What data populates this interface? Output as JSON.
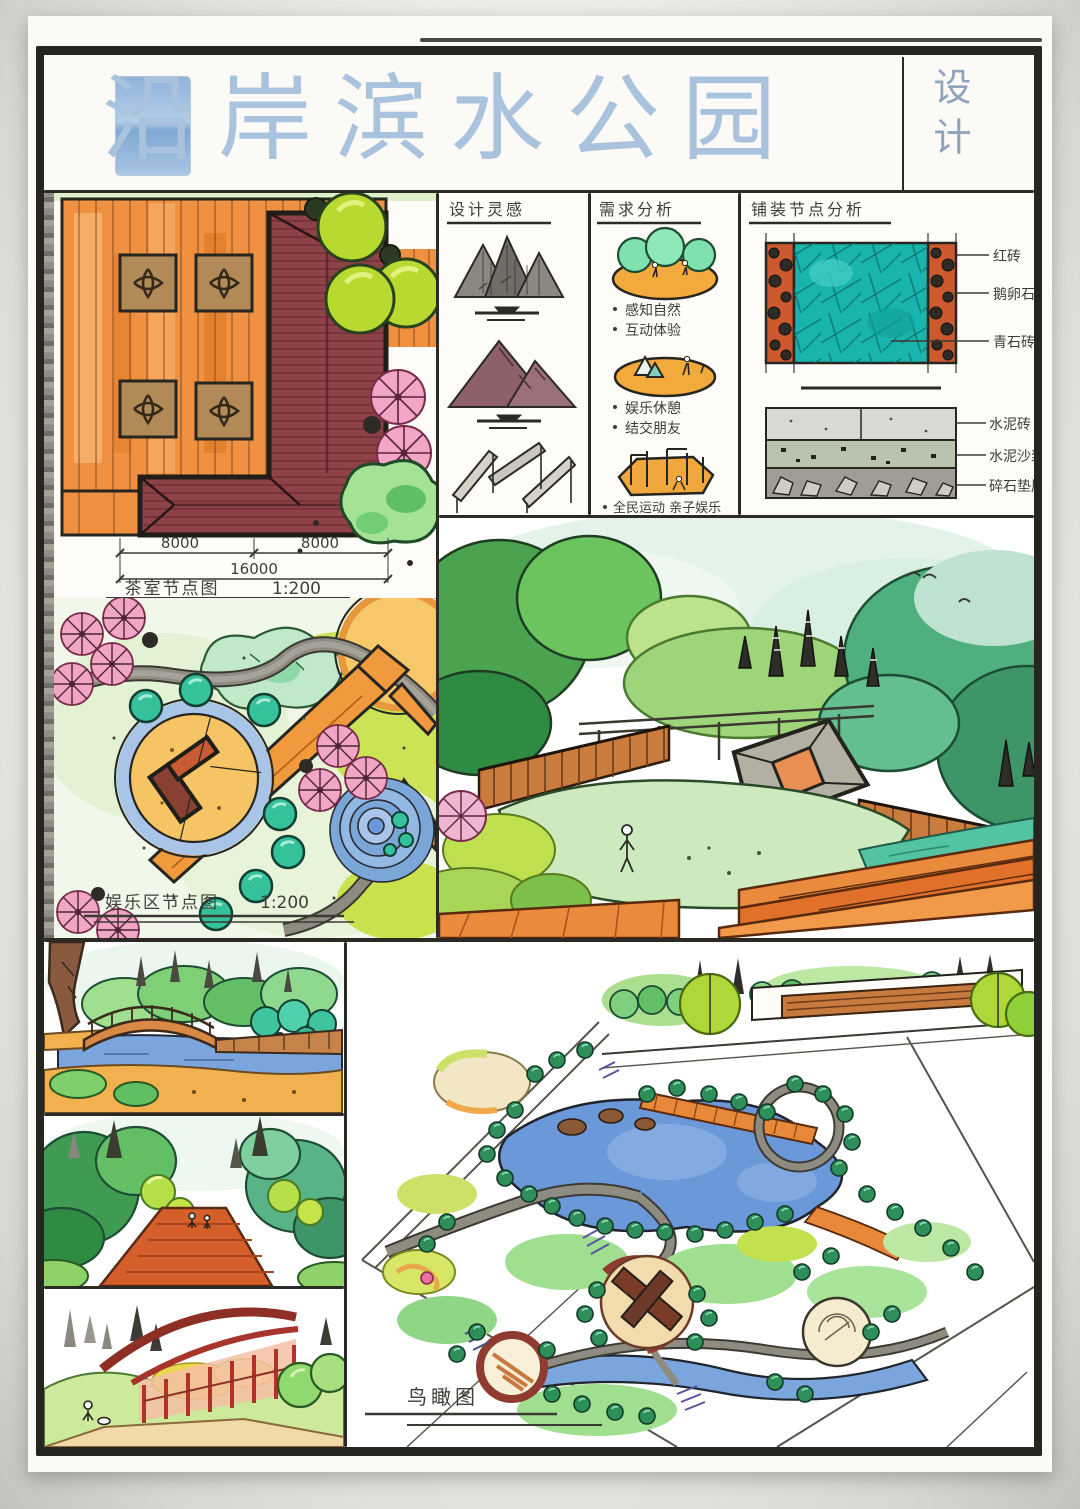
{
  "title": {
    "main": "沿岸滨水公园",
    "suffix": "设计"
  },
  "panels": {
    "tea_plan": {
      "caption": "茶室节点图",
      "scale": "1:200",
      "dimensions": {
        "left": "8000",
        "right": "8000",
        "total": "16000"
      }
    },
    "design_inspiration": {
      "header": "设计灵感"
    },
    "needs_analysis": {
      "header": "需求分析",
      "bullets": [
        "感知自然",
        "互动体验",
        "娱乐休憩",
        "结交朋友",
        "全民运动 亲子娱乐"
      ]
    },
    "paving_analysis": {
      "header": "铺装节点分析",
      "plan_labels": [
        "红砖",
        "鹅卵石",
        "青石砖"
      ],
      "section_labels": [
        "水泥砖",
        "水泥沙浆",
        "碎石垫层"
      ]
    },
    "entertainment_plan": {
      "caption": "娱乐区节点图",
      "scale": "1:200"
    },
    "bird_eye_view": {
      "caption": "鸟瞰图"
    }
  },
  "palette": {
    "title_blue": "#a9c2de",
    "deck_orange": "#ef9140",
    "roof_maroon": "#8e4247",
    "lake_blue": "#6b98d8",
    "teal_shrub": "#35c19b",
    "pink_tree": "#f0a6c4",
    "yellow_green": "#bfe04e",
    "path_gray": "#8e8b80",
    "red_structure": "#c23b32",
    "brick_red": "#cc5a2e",
    "bluestone_teal": "#19b5ad",
    "platform_orange": "#f2aa3c"
  }
}
